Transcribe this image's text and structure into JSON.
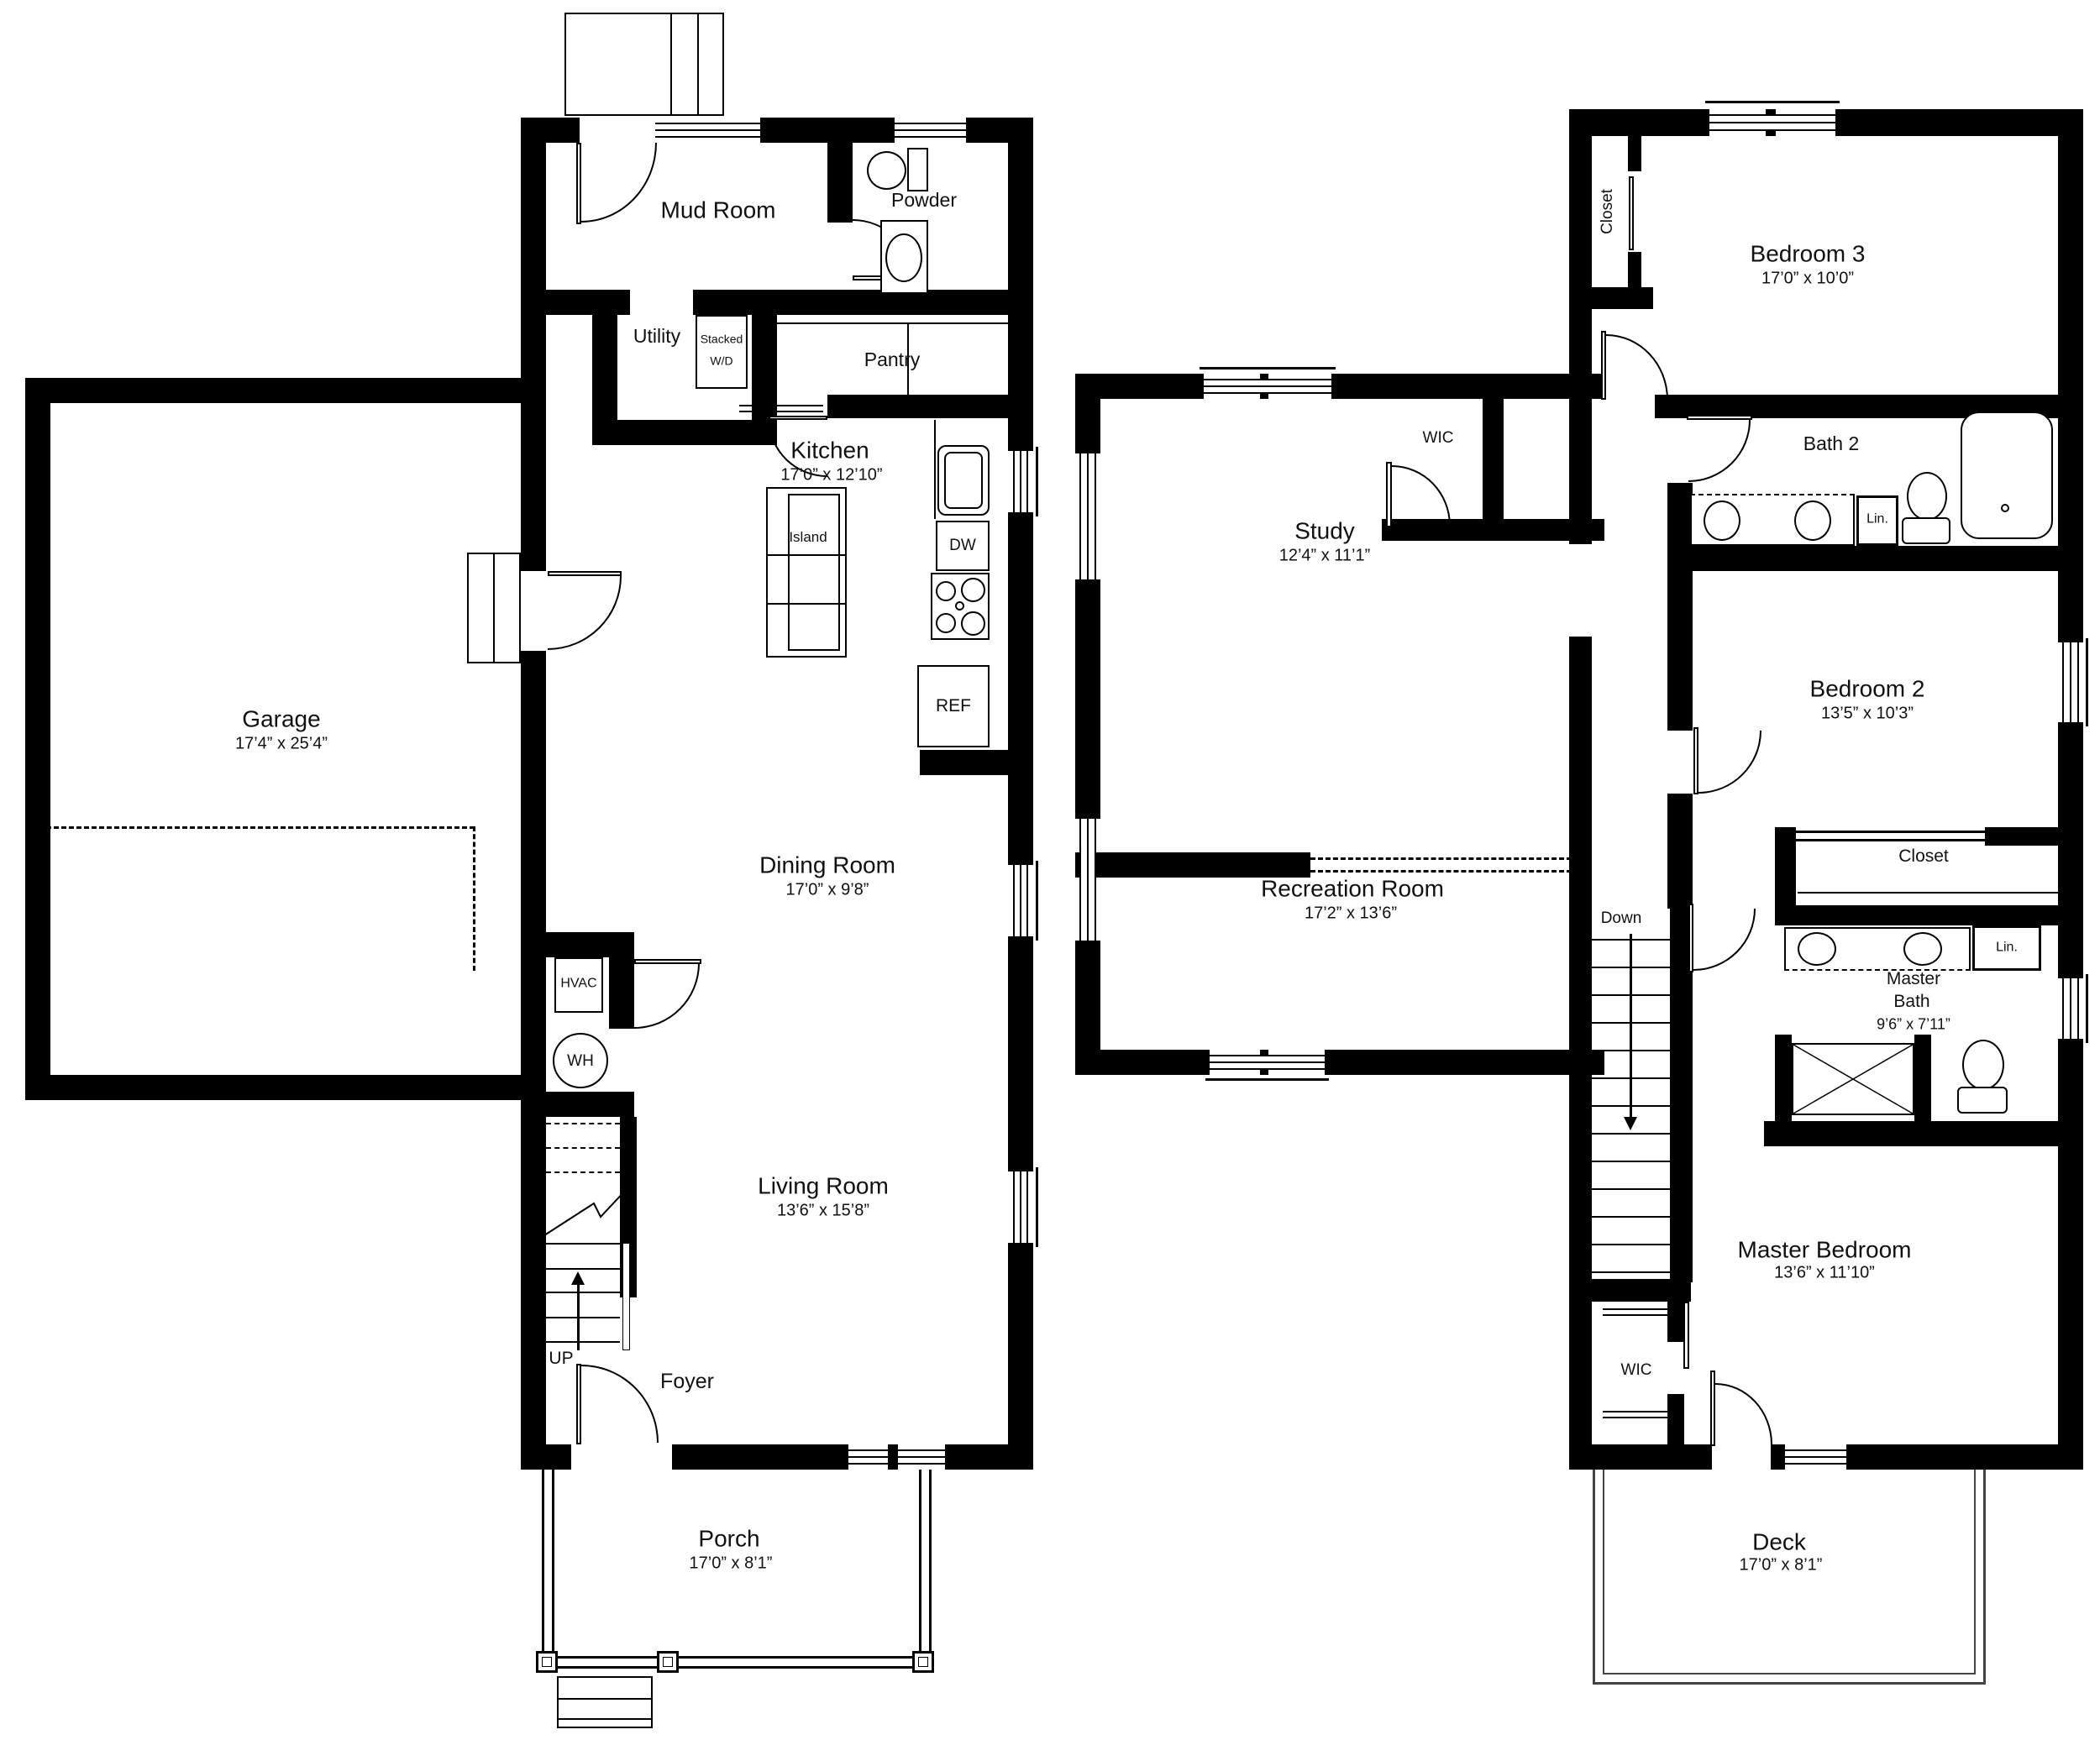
{
  "floor1": {
    "rooms": {
      "garage": {
        "name": "Garage",
        "dims": "17’4” x 25’4”"
      },
      "mud_room": {
        "name": "Mud Room"
      },
      "powder": {
        "name": "Powder"
      },
      "utility": {
        "name": "Utility"
      },
      "pantry": {
        "name": "Pantry"
      },
      "kitchen": {
        "name": "Kitchen",
        "dims": "17’0” x 12’10”"
      },
      "dining_room": {
        "name": "Dining Room",
        "dims": "17’0” x 9’8”"
      },
      "living_room": {
        "name": "Living Room",
        "dims": "13’6” x 15’8”"
      },
      "foyer": {
        "name": "Foyer"
      },
      "porch": {
        "name": "Porch",
        "dims": "17’0” x 8’1”"
      }
    },
    "fixtures": {
      "island": "Island",
      "stacked_1": "Stacked",
      "stacked_2": "W/D",
      "dw": "DW",
      "ref": "REF",
      "hvac": "HVAC",
      "wh": "WH",
      "up": "UP"
    }
  },
  "floor2": {
    "rooms": {
      "bedroom3": {
        "name": "Bedroom 3",
        "dims": "17’0” x 10’0”"
      },
      "bath2": {
        "name": "Bath 2"
      },
      "study": {
        "name": "Study",
        "dims": "12’4” x 11’1”"
      },
      "bedroom2": {
        "name": "Bedroom 2",
        "dims": "13’5” x 10’3”"
      },
      "recreation": {
        "name": "Recreation Room",
        "dims": "17’2” x 13’6”"
      },
      "master_bath": {
        "name1": "Master",
        "name2": "Bath",
        "dims": "9’6” x 7’11”"
      },
      "master_bedroom": {
        "name": "Master Bedroom",
        "dims": "13’6” x 11’10”"
      },
      "deck": {
        "name": "Deck",
        "dims": "17’0” x 8’1”"
      }
    },
    "fixtures": {
      "closet_b3": "Closet",
      "wic_hall": "WIC",
      "closet_b2": "Closet",
      "lin_bath2": "Lin.",
      "lin_master": "Lin.",
      "wic_master": "WIC",
      "down": "Down"
    }
  }
}
